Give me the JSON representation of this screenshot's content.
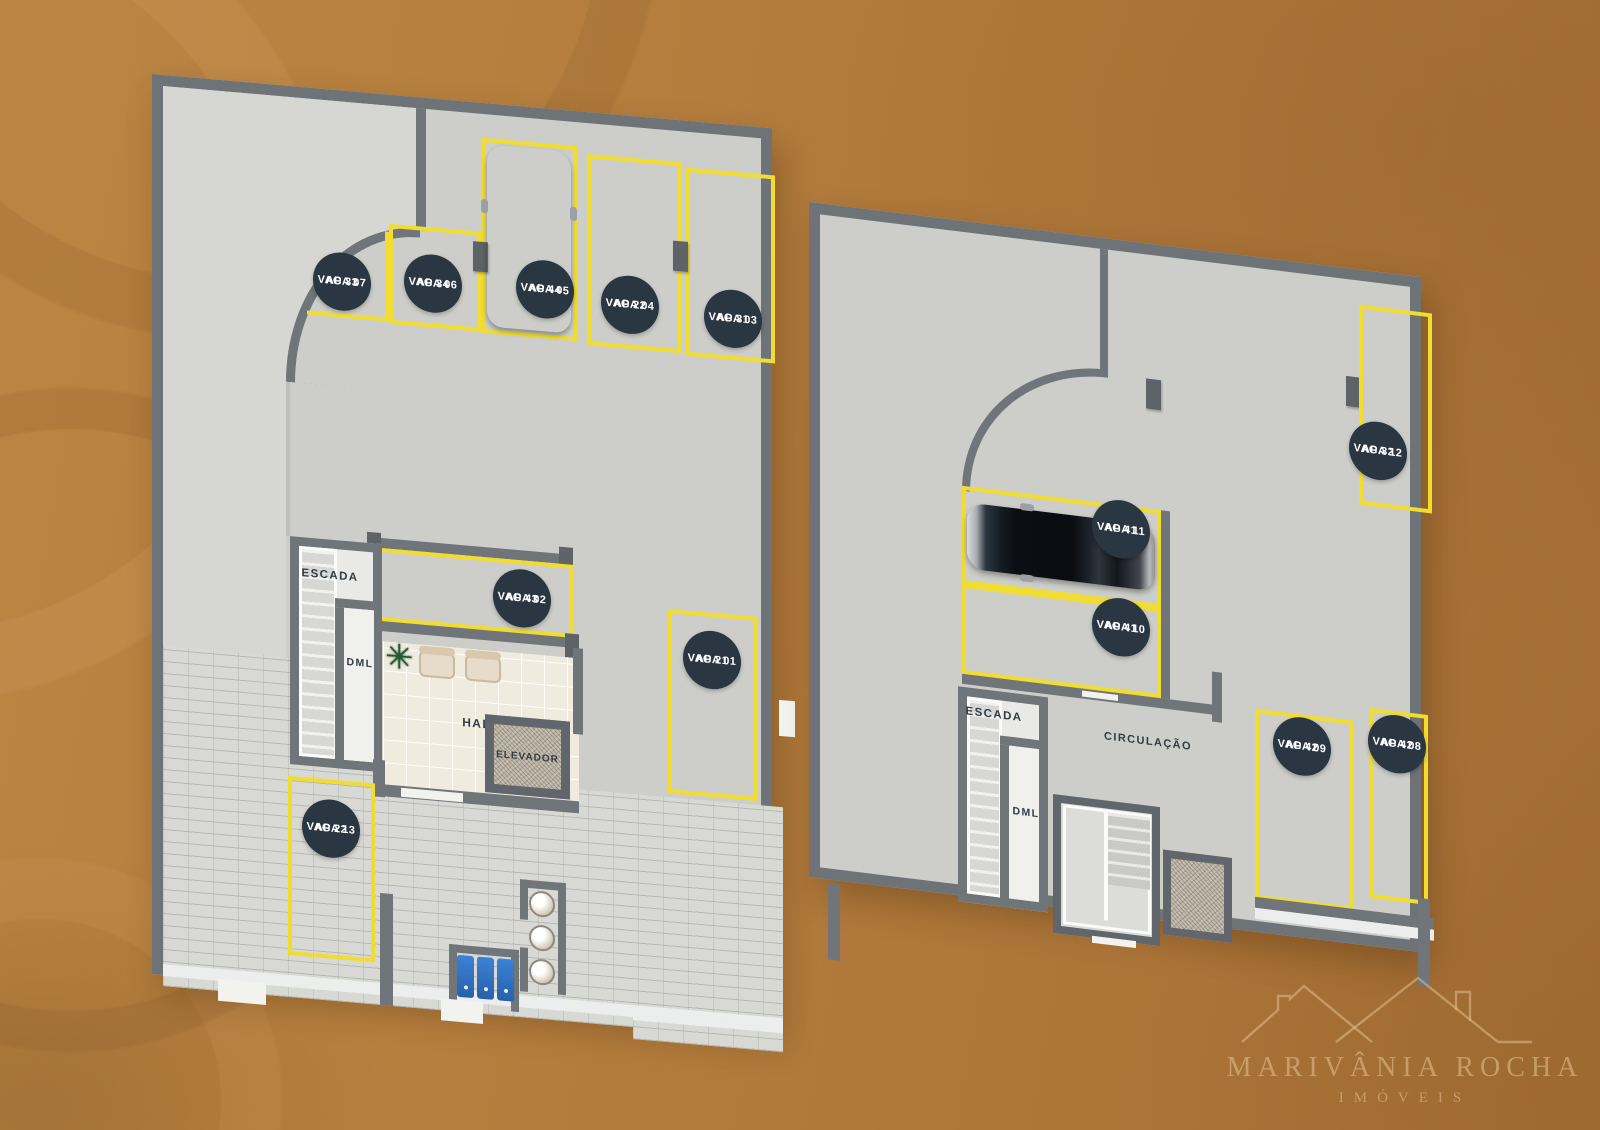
{
  "watermark": {
    "line1": "MARIVÂNIA ROCHA",
    "line2": "IMÓVEIS"
  },
  "left_plan": {
    "labels": {
      "escada": "ESCADA",
      "dml": "DML",
      "hall": "HALL",
      "elevador": "ELEVADOR"
    },
    "spots": [
      {
        "l1": "AP 33",
        "l2": "VAGA 07"
      },
      {
        "l1": "AP 34",
        "l2": "VAGA 06"
      },
      {
        "l1": "AP 44",
        "l2": "VAGA 05"
      },
      {
        "l1": "AP 22",
        "l2": "VAGA 04"
      },
      {
        "l1": "AP 31",
        "l2": "VAGA 03"
      },
      {
        "l1": "AP 43",
        "l2": "VAGA 02"
      },
      {
        "l1": "AP 21",
        "l2": "VAGA 01"
      },
      {
        "l1": "AP 22",
        "l2": "VAGA 13"
      }
    ]
  },
  "right_plan": {
    "labels": {
      "escada": "ESCADA",
      "dml": "DML",
      "circulacao": "CIRCULAÇÃO"
    },
    "spots": [
      {
        "l1": "AP 32",
        "l2": "VAGA 12"
      },
      {
        "l1": "AP 41",
        "l2": "VAGA 11"
      },
      {
        "l1": "AP 41",
        "l2": "VAGA 10"
      },
      {
        "l1": "AP 42",
        "l2": "VAGA 09"
      },
      {
        "l1": "AP 42",
        "l2": "VAGA 08"
      }
    ]
  },
  "colors": {
    "background": "#b8813f",
    "floor": "#cdcec9",
    "wall": "#6e7377",
    "parking_line": "#f1dd30",
    "badge": "#2a3642",
    "badge_text": "#ffffff",
    "watermark": "#e2c494"
  }
}
